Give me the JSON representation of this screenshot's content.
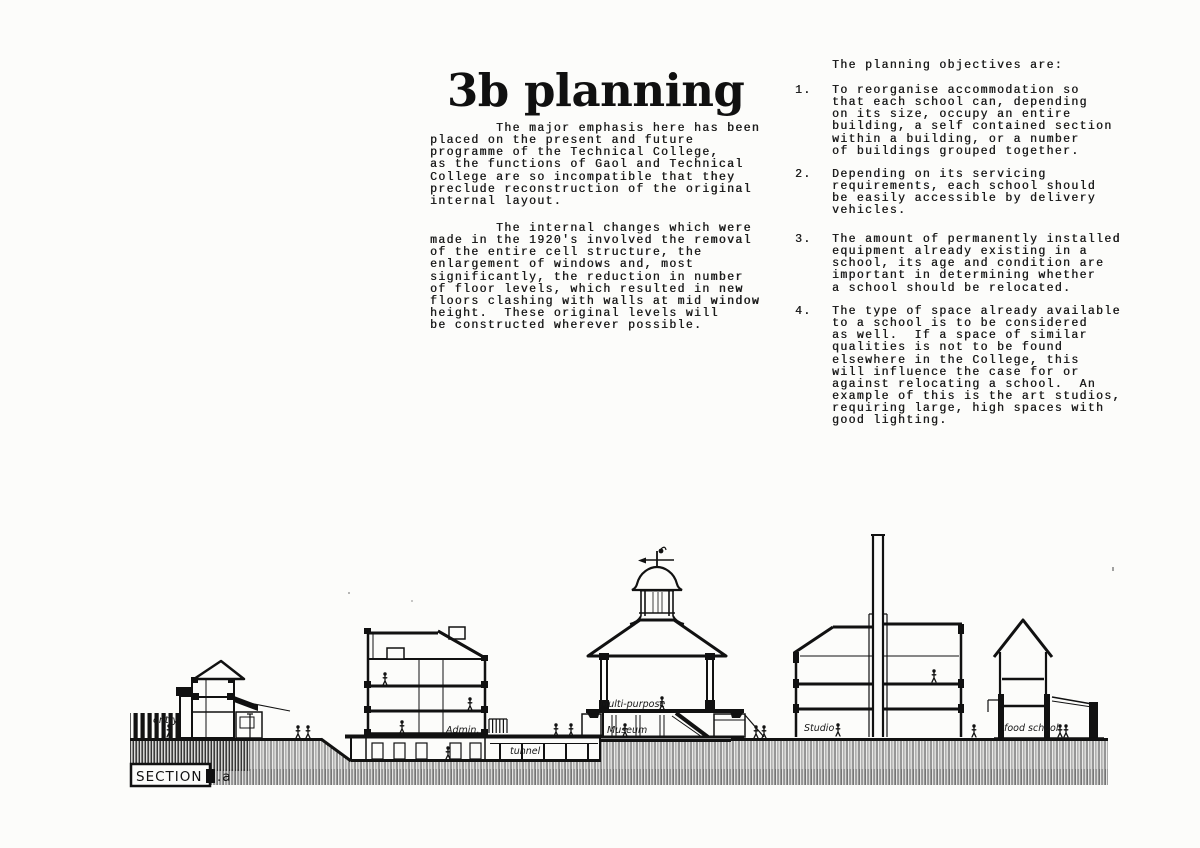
{
  "doc": {
    "title": "3b planning",
    "left_column": {
      "para1": "        The major emphasis here has been\nplaced on the present and future\nprogramme of the Technical College,\nas the functions of Gaol and Technical\nCollege are so incompatible that they\npreclude reconstruction of the original\ninternal layout.",
      "para2": "        The internal changes which were\nmade in the 1920's involved the removal\nof the entire cell structure, the\nenlargement of windows and, most\nsignificantly, the reduction in number\nof floor levels, which resulted in new\nfloors clashing with walls at mid window\nheight.  These original levels will\nbe constructed wherever possible."
    },
    "right_column": {
      "intro": "The planning objectives are:",
      "objectives": [
        {
          "num": "1.",
          "text": "To reorganise accommodation so\nthat each school can, depending\non its size, occupy an entire\nbuilding, a self contained section\nwithin a building, or a number\nof buildings grouped together."
        },
        {
          "num": "2.",
          "text": "Depending on its servicing\nrequirements, each school should\nbe easily accessible by delivery\nvehicles."
        },
        {
          "num": "3.",
          "text": "The amount of permanently installed\nequipment already existing in a\nschool, its age and condition are\nimportant in determining whether\na school should be relocated."
        },
        {
          "num": "4.",
          "text": "The type of space already available\nto a school is to be considered\nas well.  If a space of similar\nqualities is not to be found\nelsewhere in the College, this\nwill influence the case for or\nagainst relocating a school.  An\nexample of this is the art studios,\nrequiring large, high spaces with\ngood lighting."
        }
      ]
    },
    "drawing": {
      "section_label": "SECTION a.a",
      "labels": {
        "entry": "entry",
        "admin": "Admin.",
        "tunnel": "tunnel",
        "multi_purpose": "Multi-purpose",
        "museum": "Museum",
        "studio": "Studio",
        "food_school": "food school"
      },
      "ink_color": "#161616",
      "paper_color": "#fcfcfa"
    }
  }
}
